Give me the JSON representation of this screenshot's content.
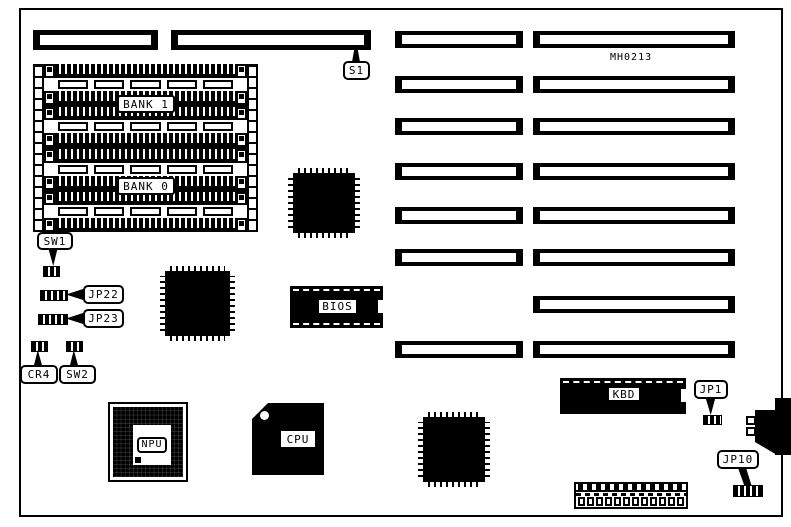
{
  "board": {
    "model": "MH0213",
    "callouts": {
      "s1": "S1",
      "sw1": "SW1",
      "jp22": "JP22",
      "jp23": "JP23",
      "cr4": "CR4",
      "sw2": "SW2",
      "jp1": "JP1",
      "jp10": "JP10"
    },
    "chips": {
      "bank1": "BANK 1",
      "bank0": "BANK 0",
      "bios": "BIOS",
      "npu": "NPU",
      "cpu": "CPU",
      "kbd": "KBD"
    },
    "colors": {
      "ink": "#000000",
      "paper": "#ffffff"
    }
  }
}
